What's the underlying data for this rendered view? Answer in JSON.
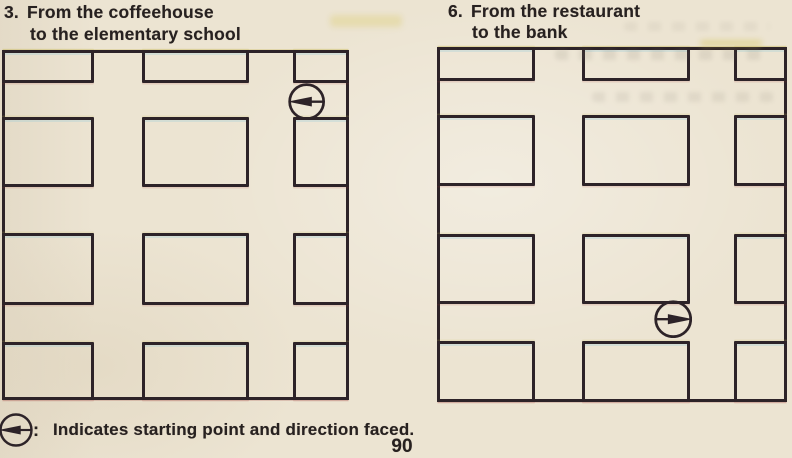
{
  "page": {
    "background_color": "#ece4d2",
    "line_color": "#2d2328",
    "text_color": "#272120",
    "page_number": "90"
  },
  "problems": [
    {
      "number": "3.",
      "line1": "From the coffeehouse",
      "line2": "to the elementary school"
    },
    {
      "number": "6.",
      "line1": "From the restaurant",
      "line2": "to the bank"
    }
  ],
  "legend": {
    "icon": "circle-arrow-left-icon",
    "separator": ":",
    "text": "Indicates starting point and direction faced."
  },
  "maps": [
    {
      "problem": "3",
      "frame": {
        "left": 2,
        "top": 50,
        "width": 347,
        "height": 350
      },
      "col_edges": [
        [
          0,
          92
        ],
        [
          140,
          247
        ],
        [
          291,
          347
        ]
      ],
      "row_edges": [
        [
          0,
          33
        ],
        [
          67,
          137
        ],
        [
          183,
          255
        ],
        [
          292,
          350
        ]
      ],
      "marker": {
        "cx": 305,
        "cy": 51.5,
        "r": 17,
        "direction": "left"
      }
    },
    {
      "problem": "6",
      "frame": {
        "left": 437,
        "top": 47,
        "width": 350,
        "height": 355
      },
      "col_edges": [
        [
          0,
          98
        ],
        [
          145,
          253
        ],
        [
          297,
          350
        ]
      ],
      "row_edges": [
        [
          0,
          34
        ],
        [
          68,
          139
        ],
        [
          187,
          257
        ],
        [
          294,
          355
        ]
      ],
      "marker": {
        "cx": 236,
        "cy": 272,
        "r": 17.5,
        "direction": "right"
      }
    }
  ]
}
